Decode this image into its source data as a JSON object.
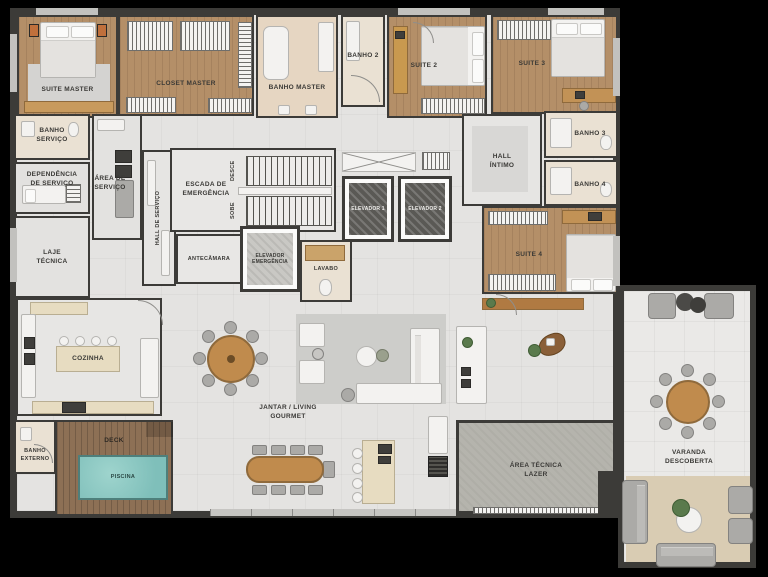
{
  "plan_type": "apartment-floorplan",
  "colors": {
    "background": "#000000",
    "wall": "#3c3b38",
    "floor": "#e4e3e1",
    "wood_floor": "#b48f68",
    "deck_wood": "#8d7055",
    "tile": "#eae1d3",
    "pool_water": "#8ac7c1",
    "concrete": "#b5b4ad",
    "island_beige": "#e7dcc1",
    "table_wood": "#c08b4d"
  },
  "rooms": {
    "suite_master": {
      "label": "SUITE MASTER"
    },
    "closet_master": {
      "label": "CLOSET MASTER"
    },
    "banho_master": {
      "label": "BANHO MASTER"
    },
    "banho_2": {
      "label": "BANHO 2"
    },
    "suite_2": {
      "label": "SUITE 2"
    },
    "suite_3": {
      "label": "SUITE 3"
    },
    "banho_servico": {
      "label": "BANHO\nSERVIÇO"
    },
    "dependencia_servico": {
      "label": "DEPENDÊNCIA\nDE SERVIÇO"
    },
    "area_servico": {
      "label": "ÁREA DE\nSERVIÇO"
    },
    "laje_tecnica": {
      "label": "LAJE\nTÉCNICA"
    },
    "escada_emergencia": {
      "label": "ESCADA DE\nEMERGÊNCIA"
    },
    "desce": {
      "label": "DESCE"
    },
    "sobe": {
      "label": "SOBE"
    },
    "hall_servico": {
      "label": "HALL DE SERVIÇO"
    },
    "antecamara": {
      "label": "ANTECÂMARA"
    },
    "elevador_emergencia": {
      "label": "ELEVADOR\nEMERGÊNCIA"
    },
    "lavabo": {
      "label": "LAVABO"
    },
    "elevador_1": {
      "label": "ELEVADOR 1"
    },
    "elevador_2": {
      "label": "ELEVADOR 2"
    },
    "hall_intimo": {
      "label": "HALL\nÍNTIMO"
    },
    "banho_3": {
      "label": "BANHO 3"
    },
    "banho_4": {
      "label": "BANHO 4"
    },
    "suite_4": {
      "label": "SUITE 4"
    },
    "cozinha": {
      "label": "COZINHA"
    },
    "jantar_living": {
      "label": "JANTAR / LIVING\nGOURMET"
    },
    "deck": {
      "label": "DECK"
    },
    "piscina": {
      "label": "PISCINA"
    },
    "banho_externo": {
      "label": "BANHO\nEXTERNO"
    },
    "area_tecnica_lazer": {
      "label": "ÁREA TÉCNICA\nLAZER"
    },
    "varanda_descoberta": {
      "label": "VARANDA\nDESCOBERTA"
    }
  }
}
